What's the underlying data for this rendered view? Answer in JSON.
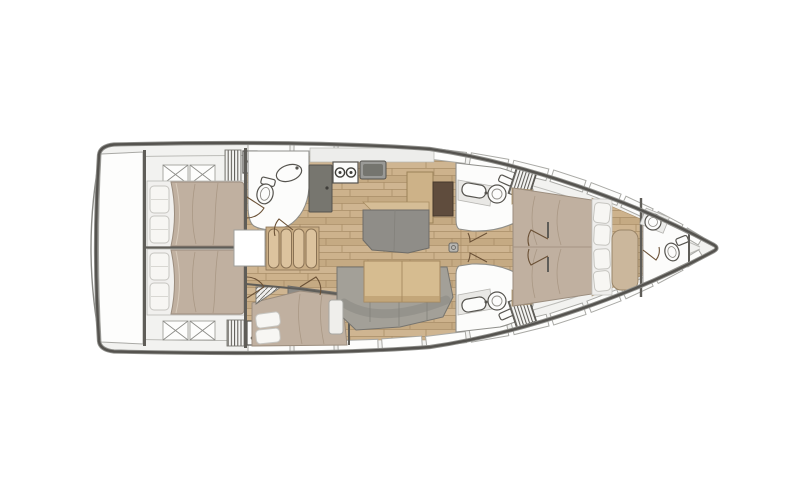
{
  "page": {
    "background": "#ffffff",
    "description": "Top-down interior deck plan of a sailing yacht, bow pointing right"
  },
  "colors": {
    "deck": "#f2f2f0",
    "hull_outline": "#55534f",
    "hull_outer": "#8f8f8b",
    "inner_line": "#bcbcb8",
    "panel": "#fdfdfc",
    "panel_stroke": "#a9a9a5",
    "bulkhead": "#5f5d58",
    "wood": "#c9ae89",
    "wood_line": "#aa8e68",
    "wood_trim": "#d5bd96",
    "duvet": "#c0b0a0",
    "duvet_line": "#a4927e",
    "pillow": "#f7f6f3",
    "sofa": "#a3a098",
    "furniture": "#8f8d88",
    "cabinet": "#77766f",
    "nav_brown": "#5f4c3d",
    "table": "#d6bc90",
    "fixture": "#fcfcfb",
    "fixture_stroke": "#56544f",
    "stairs": "#dcc39e",
    "door": "#6b5136"
  },
  "plan": {
    "orientation": "bow-right",
    "cabin_count": 4,
    "head_count": 4,
    "galley_burners": 2,
    "stair_treads": 4,
    "features": [
      "swim-platform",
      "aft-cabin-port",
      "aft-cabin-starboard",
      "aft-head",
      "companionway-stairs",
      "galley",
      "nav-station",
      "saloon-sofa",
      "saloon-table",
      "midship-cabin",
      "forward-head-port",
      "forward-head-starboard",
      "forward-cabin",
      "bow-head",
      "anchor-locker"
    ]
  }
}
